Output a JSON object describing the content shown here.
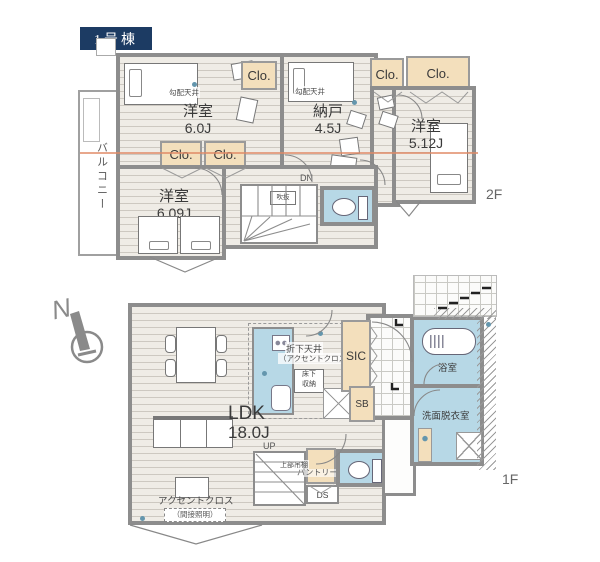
{
  "title_badge": "1号棟",
  "compass": {
    "north": "N"
  },
  "colors": {
    "badge_navy": "#1c3b63",
    "closet_tan": "#f3dfbc",
    "wet_area_blue": "#b7d8e6",
    "wall_gray": "#8d8d8d",
    "section_line_orange": "#e08a66"
  },
  "floor2": {
    "floor_label": "2F",
    "balcony": "バルコニー",
    "closet": "Clo.",
    "sloped_ceiling": "勾配天井",
    "void": "吹抜",
    "stairs_down": "DN",
    "rooms": {
      "bedroom_a": {
        "name": "洋室",
        "size": "6.0J"
      },
      "storage": {
        "name": "納戸",
        "size": "4.5J"
      },
      "bedroom_b": {
        "name": "洋室",
        "size": "5.12J"
      },
      "bedroom_c": {
        "name": "洋室",
        "size": "6.09J"
      }
    }
  },
  "floor1": {
    "floor_label": "1F",
    "stairs_up": "UP",
    "ldk": {
      "name": "LDK",
      "size": "18.0J"
    },
    "kitchen_ceiling_note": {
      "line1": "折下天井",
      "line2": "（アクセントクロス）"
    },
    "underfloor_storage": {
      "line1": "床下",
      "line2": "収納"
    },
    "shoe_closet": "SIC",
    "shoe_box": "SB",
    "bathroom": "浴室",
    "washroom": "洗面脱衣室",
    "pantry": "パントリー",
    "pantry_note": "上部吊棚",
    "duct_space": "DS",
    "accent_wall": "アクセントクロス",
    "accent_note": "（間接照明）"
  }
}
